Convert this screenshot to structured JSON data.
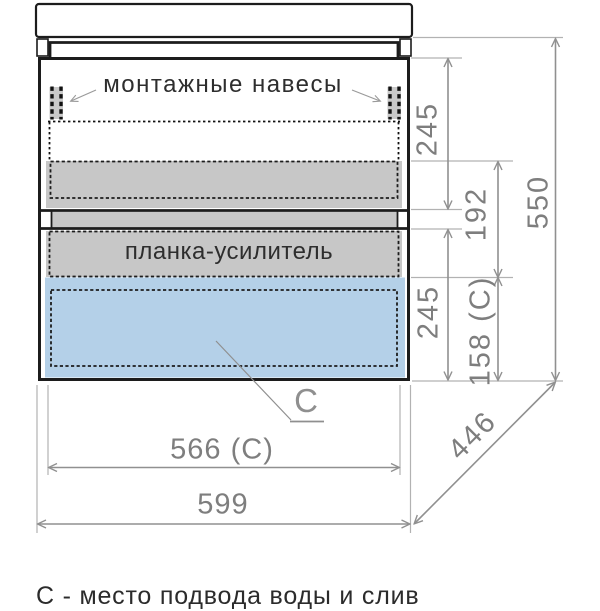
{
  "diagram": {
    "labels": {
      "mounting": "монтажные навесы",
      "reinforcement": "планка-усилитель",
      "c_marker": "С"
    },
    "dimensions": {
      "drawer_top_height": "245",
      "middle_gap_height": "192",
      "drawer_bottom_height": "245",
      "c_zone_height": "158 (С)",
      "overall_height": "550",
      "inner_width": "566 (С)",
      "overall_width": "599",
      "depth": "446"
    },
    "caption": "С - место подвода воды и слив",
    "colors": {
      "panel_gray": "#c7c7c7",
      "water_zone_blue": "#b4d0e8",
      "line_black": "#1c1c1c",
      "dim_gray": "#909090",
      "text_gray": "#7e7e7e"
    }
  }
}
